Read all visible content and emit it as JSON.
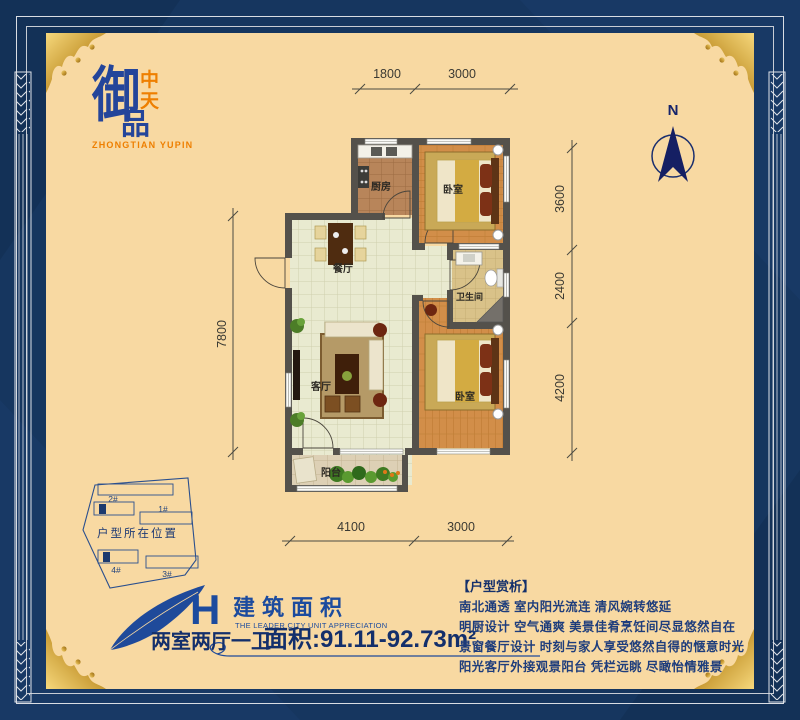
{
  "brand": {
    "logo_main": "御",
    "logo_top": "中",
    "logo_bottom": "天",
    "logo_product": "品",
    "logo_romanized": "ZHONGTIAN YUPIN"
  },
  "compass": {
    "north_label": "N"
  },
  "plan": {
    "rooms": {
      "kitchen": "厨房",
      "bedroom1": "卧室",
      "dining": "餐厅",
      "bathroom": "卫生间",
      "living": "客厅",
      "bedroom2": "卧室",
      "balcony": "阳台"
    },
    "dimensions": {
      "top": [
        "1800",
        "3000"
      ],
      "bottom": [
        "4100",
        "3000"
      ],
      "left": [
        "7800"
      ],
      "right": [
        "3600",
        "2400",
        "4200"
      ]
    }
  },
  "site_map": {
    "caption": "户型所在位置",
    "buildings": [
      "2#",
      "1#",
      "4#",
      "3#"
    ]
  },
  "title_block": {
    "unit_letter": "H",
    "title": "建筑面积",
    "subtitle": "THE LEADER CITY UNIT APPRECIATION",
    "layout": "两室两厅一卫",
    "area": "面积:91.11-92.73m²"
  },
  "analysis": {
    "heading": "【户型赏析】",
    "lines": [
      "南北通透 室内阳光流连 清风婉转悠延",
      "明厨设计 空气通爽 美景佳肴烹饪间尽显悠然自在",
      "景窗餐厅设计 时刻与家人享受悠然自得的惬意时光",
      "阳光客厅外接观景阳台 凭栏远眺 尽瞰怡情雅景"
    ]
  },
  "colors": {
    "page_background": "#16365f",
    "panel_background": "#f8d9a2",
    "brand_blue": "#1e4796",
    "accent_orange": "#ee7f00",
    "gold": "#c89b38",
    "wall": "#54514b",
    "dimension_text": "#3b3a33"
  }
}
